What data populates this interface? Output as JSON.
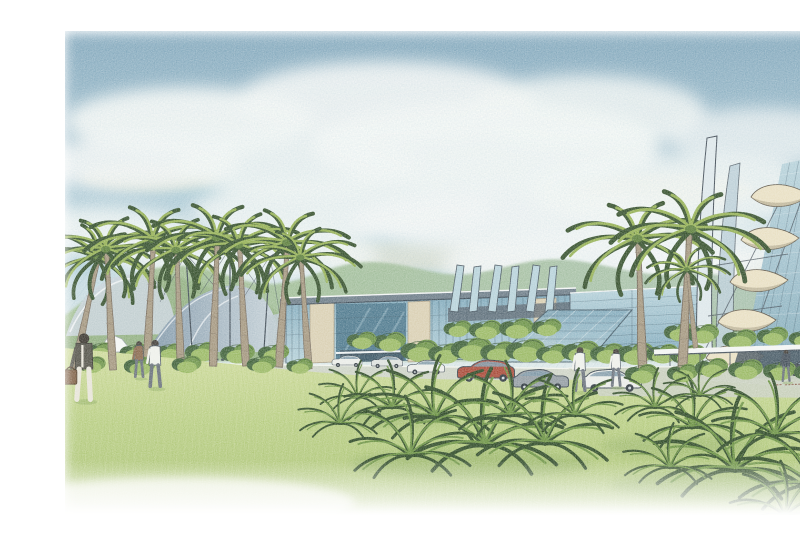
{
  "meta": {
    "description": "Watercolor and colored-pencil architectural rendering of a palm-lined modern campus: tensile fabric canopies at left, a central glass exhibition hall, a folded-fin glass pavilion, a tall sail-form tower at right, green mountains behind, a wide lawn with tropical ferns, parked cars and pedestrians under a cloudy blue sky.",
    "medium": "hand-drawn artist impression on white paper"
  },
  "palette": {
    "paper": "#ffffff",
    "sky_top": "#7fa5ba",
    "sky_mid": "#b7d2db",
    "sky_low": "#eaf1ee",
    "cloud_white": "#f8faf7",
    "cloud_warm": "#f3e7c6",
    "wisp_blue": "#8fbdc9",
    "mountain_a": "#9cba8a",
    "mountain_b": "#a7c0ad",
    "ridge": "#8fae7e",
    "hill": "#9ab989",
    "trunk": "#a4977f",
    "palm_dark": "#35502c",
    "palm_mid": "#5d7f3c",
    "palm_light": "#94b054",
    "glass_light": "#b7d2da",
    "glass_mid": "#7fa8ba",
    "glass_dark": "#4f7a8e",
    "ink": "#3f4e5a",
    "stone": "#d9cfb2",
    "roof_slab": "#6d7d88",
    "canopy_light": "#c6d2d8",
    "canopy_dark": "#8097a8",
    "fabric_white": "#f4f6f4",
    "road": "#cdd3c6",
    "curb": "#f1f3ec",
    "drive": "#c7cfbd",
    "lawn_top": "#cfdb9c",
    "lawn_mid": "#b7cd81",
    "lawn_low": "#a9c173",
    "lawn_shadow": "#8aa85e",
    "fern_dark": "#2e4a26",
    "fern_mid": "#6b9242",
    "bush_dark": "#41633a",
    "bush_mid": "#6d9348",
    "bush_light": "#9ab964",
    "car_white": "#eaece8",
    "car_pale": "#dde1dd",
    "car_red": "#a84a38",
    "car_grey": "#939ca2",
    "car_dark": "#454e54",
    "window_tint": "#7e98a6",
    "wheel": "#2e373e",
    "figure_brown": "#8a6a4e",
    "figure_white": "#eef0ea",
    "figure_dark": "#45505a",
    "cream": "#e8dfc2",
    "cream_shade": "#9a9176",
    "signature": "#8a5a48"
  },
  "scene": {
    "clouds": [
      {
        "x": 150,
        "y": 105,
        "rx": 125,
        "ry": 34,
        "o": 0.95
      },
      {
        "x": 95,
        "y": 148,
        "rx": 105,
        "ry": 26,
        "o": 0.9
      },
      {
        "x": 255,
        "y": 150,
        "rx": 120,
        "ry": 30,
        "o": 0.85
      },
      {
        "x": 345,
        "y": 85,
        "rx": 150,
        "ry": 40,
        "o": 0.9
      },
      {
        "x": 445,
        "y": 130,
        "rx": 175,
        "ry": 45,
        "o": 0.95
      },
      {
        "x": 545,
        "y": 95,
        "rx": 120,
        "ry": 36,
        "o": 0.85
      },
      {
        "x": 300,
        "y": 195,
        "rx": 150,
        "ry": 30,
        "o": 0.85
      },
      {
        "x": 480,
        "y": 205,
        "rx": 170,
        "ry": 32,
        "o": 0.9
      },
      {
        "x": 640,
        "y": 175,
        "rx": 150,
        "ry": 36,
        "o": 0.85
      },
      {
        "x": 720,
        "y": 120,
        "rx": 95,
        "ry": 28,
        "o": 0.75
      },
      {
        "x": 60,
        "y": 215,
        "rx": 95,
        "ry": 24,
        "o": 0.85
      },
      {
        "x": 680,
        "y": 235,
        "rx": 110,
        "ry": 26,
        "o": 0.8
      },
      {
        "x": 200,
        "y": 240,
        "rx": 140,
        "ry": 26,
        "o": 0.85
      },
      {
        "x": 560,
        "y": 250,
        "rx": 160,
        "ry": 28,
        "o": 0.9
      }
    ],
    "warm_glows": [
      {
        "x": 110,
        "y": 160,
        "rx": 70,
        "ry": 14,
        "o": 0.6
      },
      {
        "x": 620,
        "y": 175,
        "rx": 95,
        "ry": 18,
        "o": 0.65
      },
      {
        "x": 390,
        "y": 240,
        "rx": 110,
        "ry": 16,
        "o": 0.5
      },
      {
        "x": 700,
        "y": 250,
        "rx": 80,
        "ry": 14,
        "o": 0.5
      }
    ],
    "sky_wisps": [
      {
        "x": 210,
        "y": 170,
        "rx": 130,
        "ry": 12,
        "o": 0.4
      },
      {
        "x": 520,
        "y": 160,
        "rx": 140,
        "ry": 12,
        "o": 0.35
      },
      {
        "x": 330,
        "y": 225,
        "rx": 150,
        "ry": 10,
        "o": 0.35
      },
      {
        "x": 660,
        "y": 210,
        "rx": 110,
        "ry": 10,
        "o": 0.3
      },
      {
        "x": 130,
        "y": 250,
        "rx": 120,
        "ry": 10,
        "o": 0.3
      },
      {
        "x": 440,
        "y": 260,
        "rx": 140,
        "ry": 9,
        "o": 0.3
      }
    ],
    "palms": [
      {
        "x": 34,
        "y": 352,
        "s": 1.22,
        "r": 12
      },
      {
        "x": 72,
        "y": 354,
        "s": 1.3,
        "r": -3
      },
      {
        "x": 106,
        "y": 349,
        "s": 1.35,
        "r": 3
      },
      {
        "x": 140,
        "y": 353,
        "s": 1.28,
        "r": -2
      },
      {
        "x": 172,
        "y": 350,
        "s": 1.38,
        "r": 2
      },
      {
        "x": 205,
        "y": 350,
        "s": 1.3,
        "r": -3
      },
      {
        "x": 238,
        "y": 351,
        "s": 1.34,
        "r": 4
      },
      {
        "x": 268,
        "y": 353,
        "s": 1.2,
        "r": -4
      },
      {
        "x": 602,
        "y": 362,
        "s": 1.5,
        "r": -2
      },
      {
        "x": 643,
        "y": 360,
        "s": 1.58,
        "r": 3,
        "f": 1
      },
      {
        "x": 655,
        "y": 332,
        "s": 0.85,
        "r": -6
      }
    ],
    "cars": [
      {
        "x": 307,
        "y": 349,
        "s": 0.5,
        "c": "car_white"
      },
      {
        "x": 347,
        "y": 350,
        "s": 0.52,
        "c": "car_pale"
      },
      {
        "x": 386,
        "y": 356,
        "s": 0.62,
        "c": "car_white"
      },
      {
        "x": 446,
        "y": 362,
        "s": 0.95,
        "c": "car_red"
      },
      {
        "x": 501,
        "y": 371,
        "s": 0.92,
        "c": "car_grey",
        "f": 1
      },
      {
        "x": 572,
        "y": 372,
        "s": 0.98,
        "c": "car_white",
        "f": 1
      },
      {
        "x": 768,
        "y": 357,
        "s": 0.75,
        "c": "car_dark"
      }
    ],
    "people": [
      {
        "sym": "sym-person-bag",
        "x": 44,
        "y": 385,
        "s": 1.6
      },
      {
        "x": 99,
        "y": 362,
        "s": 0.92,
        "c": "figure_brown"
      },
      {
        "x": 115,
        "y": 372,
        "s": 1.2,
        "c": "figure_white"
      },
      {
        "x": 540,
        "y": 376,
        "s": 1.12,
        "c": "figure_white"
      },
      {
        "x": 576,
        "y": 371,
        "s": 0.95,
        "c": "figure_white"
      },
      {
        "x": 746,
        "y": 366,
        "s": 0.8,
        "c": "figure_dark"
      }
    ],
    "ferns": [
      {
        "x": 318,
        "y": 382,
        "s": 0.75
      },
      {
        "x": 352,
        "y": 392,
        "s": 0.95,
        "f": 1
      },
      {
        "x": 395,
        "y": 402,
        "s": 1.25
      },
      {
        "x": 445,
        "y": 430,
        "s": 1.55
      },
      {
        "x": 470,
        "y": 400,
        "s": 1.1,
        "f": 1
      },
      {
        "x": 505,
        "y": 428,
        "s": 1.35
      },
      {
        "x": 535,
        "y": 400,
        "s": 0.95
      },
      {
        "x": 370,
        "y": 440,
        "s": 1.2,
        "f": 1
      },
      {
        "x": 300,
        "y": 408,
        "s": 0.8
      },
      {
        "x": 615,
        "y": 392,
        "s": 0.8
      },
      {
        "x": 652,
        "y": 412,
        "s": 1.05,
        "f": 1
      },
      {
        "x": 695,
        "y": 455,
        "s": 1.55
      },
      {
        "x": 735,
        "y": 420,
        "s": 1.25,
        "f": 1
      },
      {
        "x": 772,
        "y": 470,
        "s": 1.45
      },
      {
        "x": 660,
        "y": 380,
        "s": 0.7
      },
      {
        "x": 745,
        "y": 500,
        "s": 1.1,
        "f": 1
      },
      {
        "x": 630,
        "y": 452,
        "s": 0.9
      }
    ],
    "bushes_back": [
      {
        "x": 380,
        "y": 342,
        "s": 1.15
      },
      {
        "x": 406,
        "y": 344,
        "s": 1.05
      },
      {
        "x": 432,
        "y": 341,
        "s": 1.25
      },
      {
        "x": 459,
        "y": 343,
        "s": 1.1
      },
      {
        "x": 486,
        "y": 342,
        "s": 1.2
      },
      {
        "x": 513,
        "y": 344,
        "s": 1.0
      },
      {
        "x": 541,
        "y": 343,
        "s": 1.15
      },
      {
        "x": 568,
        "y": 344,
        "s": 1.05
      },
      {
        "x": 596,
        "y": 345,
        "s": 1.15
      },
      {
        "x": 623,
        "y": 344,
        "s": 1.0
      },
      {
        "x": 649,
        "y": 346,
        "s": 1.1
      },
      {
        "x": 350,
        "y": 332,
        "s": 1.0
      },
      {
        "x": 322,
        "y": 330,
        "s": 0.9
      },
      {
        "x": 418,
        "y": 318,
        "s": 0.85
      },
      {
        "x": 446,
        "y": 320,
        "s": 1.0
      },
      {
        "x": 477,
        "y": 319,
        "s": 1.05
      },
      {
        "x": 507,
        "y": 317,
        "s": 0.9
      },
      {
        "x": 640,
        "y": 322,
        "s": 0.95
      },
      {
        "x": 663,
        "y": 324,
        "s": 1.0
      },
      {
        "x": 700,
        "y": 330,
        "s": 1.05
      },
      {
        "x": 733,
        "y": 326,
        "s": 0.95
      },
      {
        "x": 764,
        "y": 328,
        "s": 0.9
      },
      {
        "x": 60,
        "y": 340,
        "s": 0.85
      },
      {
        "x": 95,
        "y": 342,
        "s": 0.9
      },
      {
        "x": 130,
        "y": 341,
        "s": 0.85
      },
      {
        "x": 162,
        "y": 342,
        "s": 1.0
      },
      {
        "x": 198,
        "y": 344,
        "s": 1.05
      },
      {
        "x": 234,
        "y": 343,
        "s": 0.95
      }
    ],
    "bushes_front": [
      {
        "x": 52,
        "y": 354,
        "s": 0.85
      },
      {
        "x": 100,
        "y": 356,
        "s": 0.95
      },
      {
        "x": 147,
        "y": 354,
        "s": 0.9
      },
      {
        "x": 222,
        "y": 354,
        "s": 0.9
      },
      {
        "x": 260,
        "y": 355,
        "s": 0.8
      },
      {
        "x": 602,
        "y": 364,
        "s": 1.0
      },
      {
        "x": 643,
        "y": 363,
        "s": 0.95
      },
      {
        "x": 672,
        "y": 358,
        "s": 1.0
      },
      {
        "x": 706,
        "y": 360,
        "s": 1.05
      },
      {
        "x": 740,
        "y": 361,
        "s": 1.0
      },
      {
        "x": 770,
        "y": 362,
        "s": 0.95
      }
    ]
  },
  "signature": {
    "mark": "illegible artist initials and year",
    "color": "#8a5a48"
  }
}
